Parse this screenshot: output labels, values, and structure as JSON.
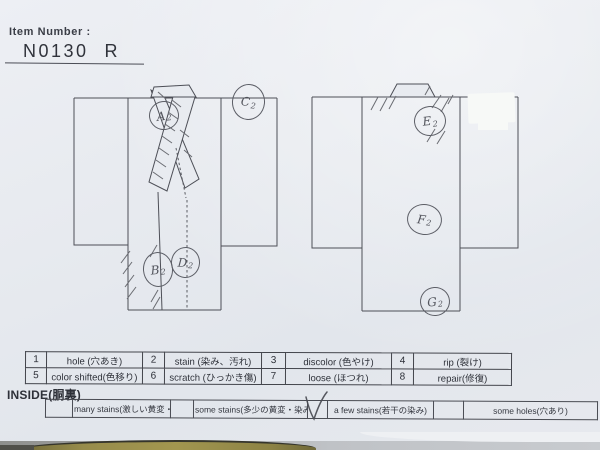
{
  "header": {
    "item_number_label": "Item Number :",
    "item_number": "N0130",
    "grade": "R"
  },
  "diagram": {
    "front_markers": {
      "a2": {
        "letter": "A",
        "sub": "2"
      },
      "b2": {
        "letter": "B",
        "sub": "2"
      },
      "c2": {
        "letter": "C",
        "sub": "2"
      },
      "d2": {
        "letter": "D",
        "sub": "2"
      }
    },
    "back_markers": {
      "e2": {
        "letter": "E",
        "sub": "2"
      },
      "f2": {
        "letter": "F",
        "sub": "2"
      },
      "g2": {
        "letter": "G",
        "sub": "2"
      }
    }
  },
  "condition_table": {
    "rows": [
      {
        "cells": [
          {
            "num": "1",
            "label": "hole (穴あき)"
          },
          {
            "num": "2",
            "label": "stain (染み、汚れ)"
          },
          {
            "num": "3",
            "label": "discolor (色やけ)"
          },
          {
            "num": "4",
            "label": "rip (裂け)"
          }
        ]
      },
      {
        "cells": [
          {
            "num": "5",
            "label": "color shifted(色移り)"
          },
          {
            "num": "6",
            "label": "scratch (ひっかき傷)"
          },
          {
            "num": "7",
            "label": "loose (ほつれ)"
          },
          {
            "num": "8",
            "label": "repair(修復)"
          }
        ]
      }
    ]
  },
  "inside": {
    "label": "INSIDE(胴裏)",
    "options": [
      {
        "label": "many stains(激しい黄変・染み)",
        "checked": false
      },
      {
        "label": "some stains(多少の黄変・染み)",
        "checked": false
      },
      {
        "label": "a few stains(若干の染み)",
        "checked": true
      },
      {
        "label": "some holes(穴あり)",
        "checked": false
      }
    ],
    "checkmark": "V"
  },
  "colors": {
    "paper": "#e7eaef",
    "print_line": "#4d4f57",
    "pencil": "#5f6167",
    "fabric": "#94894a"
  }
}
